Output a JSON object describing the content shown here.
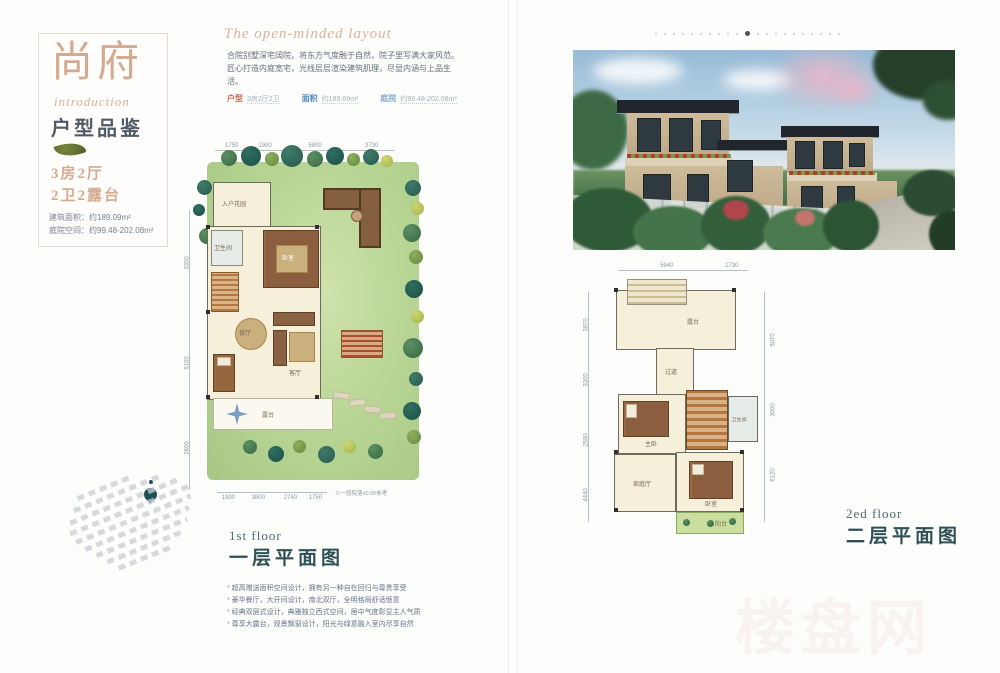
{
  "brand": {
    "name": "尚府",
    "script": "introduction",
    "subtitle": "户型品鉴",
    "spec_line1": "3房2厅",
    "spec_line2": "2卫2露台",
    "area_line1": "建筑面积：约189.09m²",
    "area_line2": "庭院空间：约99.48-202.08m²"
  },
  "intro": {
    "script_title": "The open-minded layout",
    "line1": "合院别墅深宅阔院，将东方气度融于自然，院子里写满大家风范。",
    "line2": "匠心打造内庭宽宅，光线层层渲染建筑肌理，尽显内涵与上品生活。",
    "tags": [
      {
        "label": "户型",
        "value": "3房2厅2卫",
        "color": "#cf6b52"
      },
      {
        "label": "面积",
        "value": "约189.09m²",
        "color": "#4b87c0"
      },
      {
        "label": "庭院",
        "value": "约99.48-202.08m²",
        "color": "#85aed0"
      }
    ]
  },
  "plan1": {
    "floor_en": "1st floor",
    "floor_cn": "一层平面图",
    "dims_top": [
      "1750",
      "1900",
      "5800",
      "3730"
    ],
    "dims_left": [
      "3300",
      "5100",
      "2600"
    ],
    "dims_bottom": [
      "1900",
      "3800",
      "2740",
      "1750"
    ],
    "note": "※一层院落±0.00参考",
    "labels": {
      "entry": "入户花园",
      "bedroom": "卧室",
      "bath": "卫生间",
      "dining": "餐厅",
      "living": "客厅",
      "terrace": "露台"
    }
  },
  "plan2": {
    "floor_en": "2ed floor",
    "floor_cn": "二层平面图",
    "dims_top": [
      "5940",
      "1730"
    ],
    "dims_left": [
      "3870",
      "3300",
      "2580",
      "4440"
    ],
    "dims_right": [
      "5070",
      "3000",
      "6120"
    ],
    "labels": {
      "terrace": "露台",
      "hall": "过道",
      "master": "主卧",
      "bath": "卫生间",
      "bed": "卧室",
      "family": "家庭厅",
      "balcony": "阳台"
    }
  },
  "features": [
    "超高赠送面积空间设计，拥有另一种自在回归与尊贵享受",
    "豪华餐厅，大开间设计，南北双厅，全明格局舒适惬意",
    "经典双层式设计，典雅独立西式空间，居中气度彰显主人气质",
    "尊享大露台，观景飘窗设计，阳光与绿意融入室内尽享自然"
  ],
  "watermark": "楼盘网"
}
